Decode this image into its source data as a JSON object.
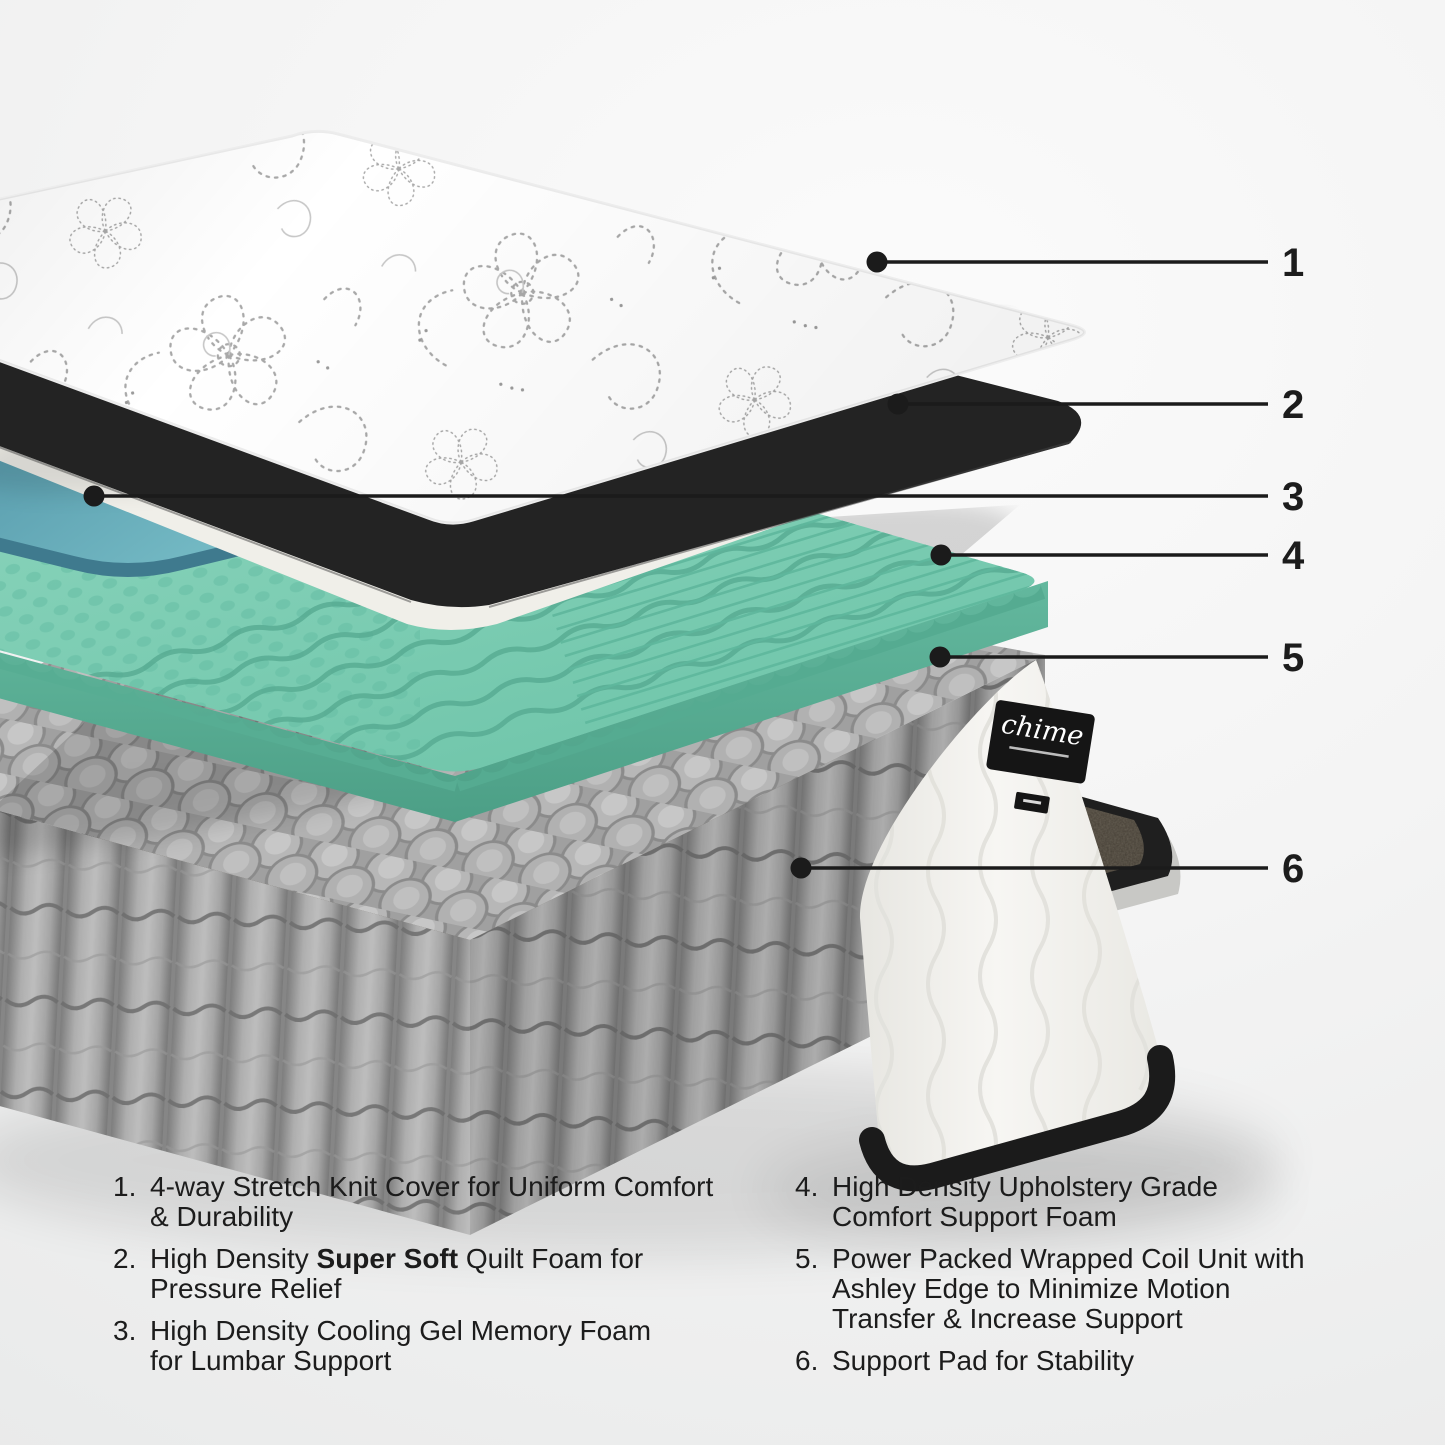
{
  "figure": {
    "kind": "mattress exploded-layer product diagram",
    "brand_tag": {
      "label": "chime"
    }
  },
  "callouts": [
    {
      "num": "1"
    },
    {
      "num": "2"
    },
    {
      "num": "3"
    },
    {
      "num": "4"
    },
    {
      "num": "5"
    },
    {
      "num": "6"
    }
  ],
  "legend": {
    "left": [
      {
        "num": "1.",
        "l1": "4-way Stretch Knit Cover for Uniform Comfort",
        "l2": "& Durability"
      },
      {
        "num": "2.",
        "l1_pre": "High Density ",
        "l1_bold": "Super Soft",
        "l1_post": " Quilt Foam for",
        "l2": "Pressure Relief"
      },
      {
        "num": "3.",
        "l1": "High Density Cooling Gel Memory Foam",
        "l2": "for Lumbar Support"
      }
    ],
    "right": [
      {
        "num": "4.",
        "l1": "High Density Upholstery Grade",
        "l2": "Comfort Support Foam"
      },
      {
        "num": "5.",
        "l1": "Power Packed Wrapped Coil Unit with",
        "l2": "Ashley Edge to Minimize Motion",
        "l3": "Transfer & Increase Support"
      },
      {
        "num": "6.",
        "l1": "Support Pad for Stability"
      }
    ]
  },
  "palette": {
    "text": "#1c1c1c",
    "callout_line": "#1b1b1b",
    "cover_fabric": "#ffffff",
    "cover_pattern": "#ababab",
    "mattress_band": "#232323",
    "quilt_foam_top": "#c9c9c7",
    "quilt_foam_side": "#f0efe9",
    "cooling_gel": "#5e9fb2",
    "comfort_foam_top": "#7ccdb3",
    "comfort_foam_side": "#57ad93",
    "coils": "#b0b0b0",
    "support_pad": "#4a443a",
    "wedge_fabric": "#f2f1ed"
  }
}
